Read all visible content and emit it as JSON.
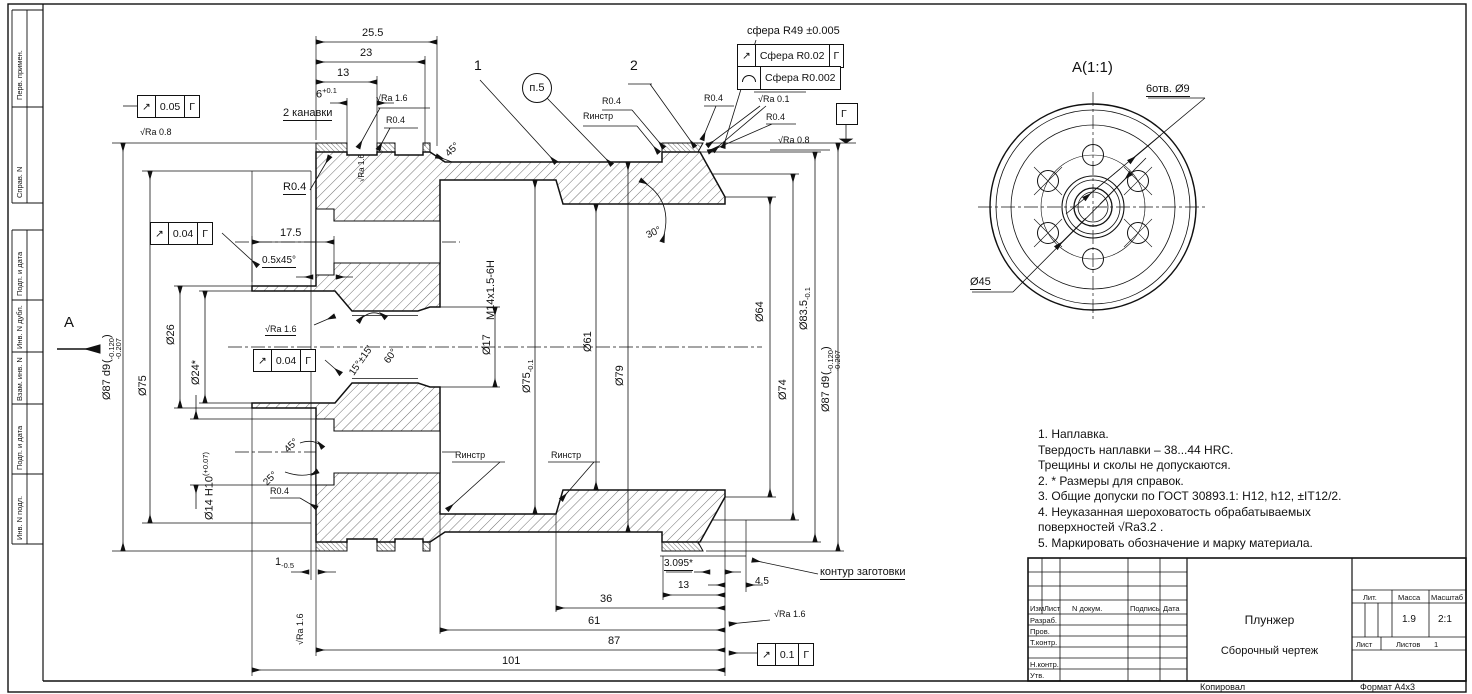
{
  "sheet": {
    "kopiroval": "Копировал",
    "format": "Формат А4х3"
  },
  "sidebar": {
    "items": [
      "Перв. примен.",
      "Справ. N",
      "Подп. и дата",
      "Инв. N дубл.",
      "Взам. инв. N",
      "Подп. и дата",
      "Инв. N подл."
    ]
  },
  "view_a": {
    "title": "А(1:1)",
    "holes": "6отв. Ø9",
    "bolt": "Ø45",
    "arrow": "А"
  },
  "callouts": {
    "c1": "1",
    "c2": "2",
    "c5": "п.5"
  },
  "surface": {
    "ra08": "√Ra 0.8",
    "ra16": "√Ra 1.6",
    "ra01": "√Ra 0.1",
    "pritert": "Притереть",
    "rinstr": "Rинстр"
  },
  "tol": {
    "runout": "↗",
    "f005": "0.05",
    "f004": "0.04",
    "f01": "0.1",
    "datum": "Г",
    "sphere1": "Сфера R0.02",
    "sphere2": "Сфера R0.002",
    "sphere_lead": "сфера R49 ±0.005"
  },
  "dims": {
    "po": "(",
    "pc": ")",
    "d25_5": "25.5",
    "d23": "23",
    "d13": "13",
    "d6": "6",
    "d6t": "+0.1",
    "kanavki": "2 канавки",
    "r04": "R0.4",
    "d17_5": "17.5",
    "ch05": "0.5x45°",
    "a45": "45°",
    "a25": "25°",
    "a30": "30°",
    "a60": "60°",
    "a15": "15°±15'",
    "d36": "36",
    "d61": "61",
    "d87": "87",
    "d101": "101",
    "d1": "1",
    "d1t": "-0.5",
    "d3095": "3.095*",
    "d13b": "13",
    "d4_5": "4.5",
    "kontur": "контур заготовки",
    "dia87": "Ø87 d9",
    "dia87t1": "-0.120",
    "dia87t2": "-0.207",
    "dia75": "Ø75",
    "dia26": "Ø26",
    "dia24": "Ø24*",
    "dia14": "Ø14 H10",
    "dia14t": "(+0.07)",
    "m14": "M14x1.5-6H",
    "dia17": "Ø17",
    "dia75b": "Ø75",
    "dia75bt": "-0.1",
    "dia61": "Ø61",
    "dia79": "Ø79",
    "dia64": "Ø64",
    "dia74": "Ø74",
    "dia835": "Ø83.5",
    "dia835t": "-0.1"
  },
  "notes": {
    "lines": [
      "1. Наплавка.",
      "Твердость наплавки – 38...44 HRC.",
      "Трещины и сколы не допускаются.",
      "2. * Размеры для справок.",
      "3. Общие допуски по ГОСТ 30893.1: H12, h12, ±IT12/2.",
      "4. Неуказанная шероховатость обрабатываемых",
      "поверхностей √Ra3.2 .",
      "5. Маркировать обозначение и марку материала."
    ]
  },
  "title_block": {
    "izm": "Изм",
    "list": "Лист",
    "ndok": "N докум.",
    "podp": "Подпись",
    "data": "Дата",
    "razrab": "Разраб.",
    "prov": "Пров.",
    "tkontr": "Т.контр.",
    "nkontr": "Н.контр.",
    "utv": "Утв.",
    "lit": "Лит.",
    "massa": "Масса",
    "masshtab": "Масштаб",
    "massa_val": "1.9",
    "scale_val": "2:1",
    "name": "Плунжер",
    "doc_type": "Сборочный чертеж",
    "list2": "Лист",
    "listov": "Листов",
    "listov_val": "1"
  }
}
